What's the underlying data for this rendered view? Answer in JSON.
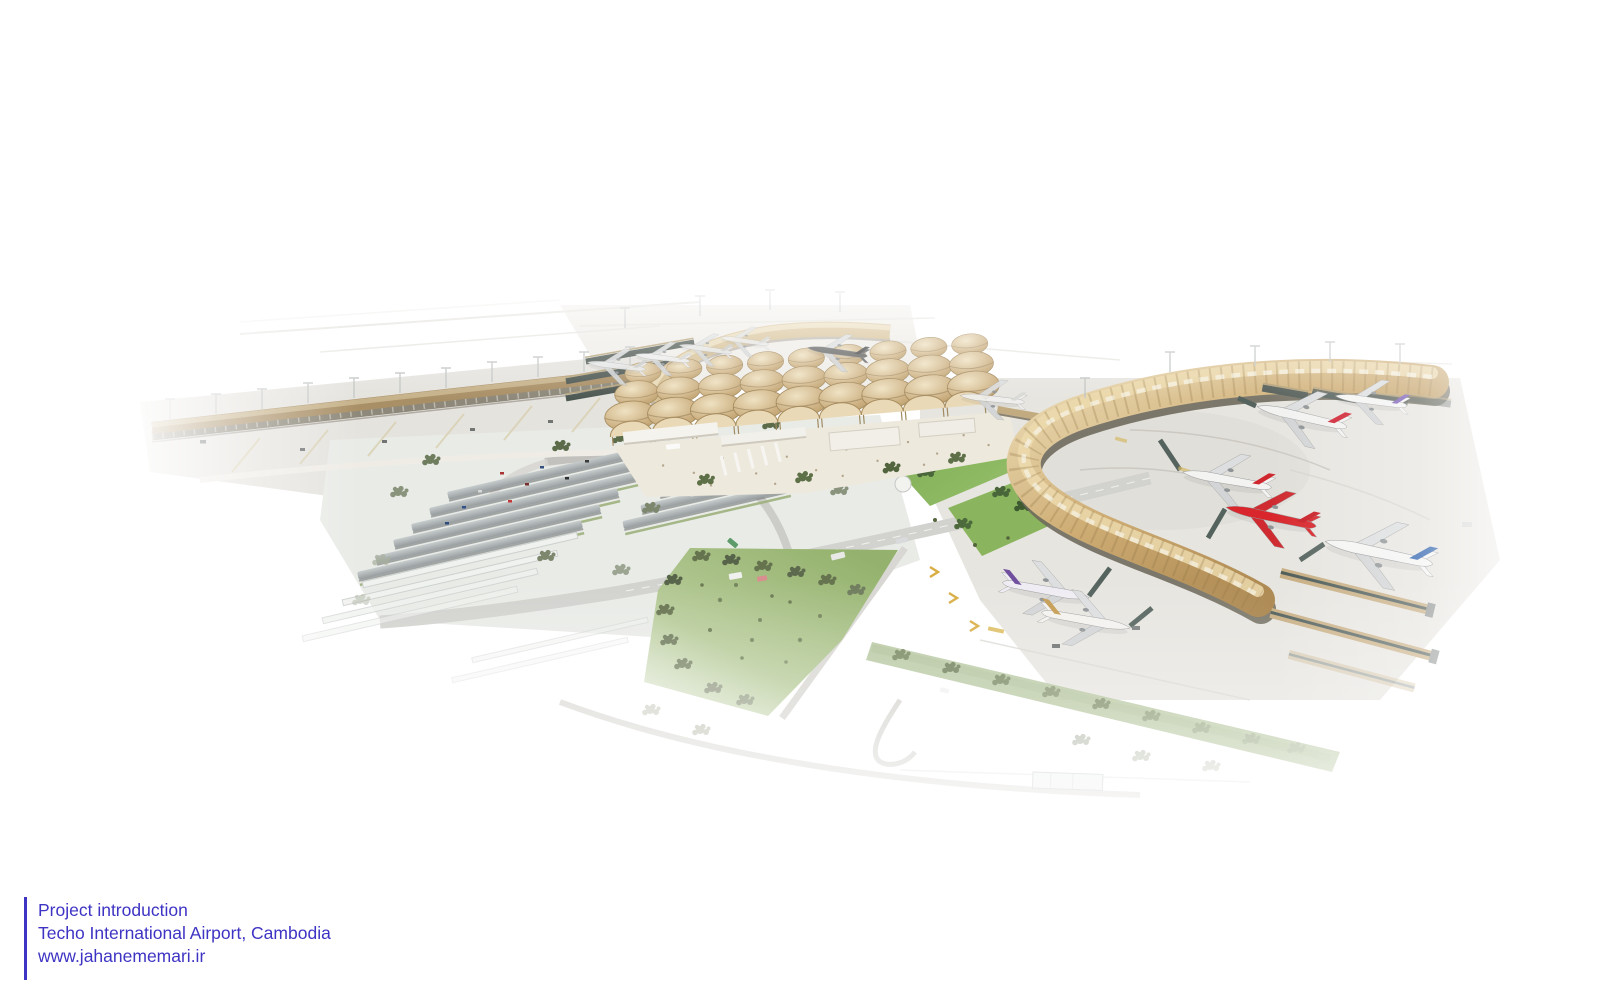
{
  "caption": {
    "line1": "Project introduction",
    "line2": "Techo International Airport, Cambodia",
    "line3": "www.jahanememari.ir"
  },
  "palette": {
    "brand": "#3e34c4",
    "terminal-roof-tan": "#cdb183",
    "terminal-roof-light": "#e8d8b4",
    "concourse-gold": "#cfae76",
    "concourse-gold-dark": "#a8834b",
    "facade-dark": "#6f6a5d",
    "apron-concrete": "#e6e4df",
    "lawn-green": "#7cab51",
    "park-green": "#9cb877",
    "tree-dark": "#4d6138",
    "tree-gray": "#7f8c6a",
    "carport-gray": "#b9bfc1",
    "road-gray": "#d2d2cf",
    "jetbridge-teal": "#4d5b57",
    "stand-marking-yellow": "#d9ae45",
    "background": "#ffffff"
  },
  "aircraft": [
    {
      "id": "remote-stand-a",
      "fuselage": "#e6e7e7",
      "tail": "#c9cccc",
      "x": 617,
      "y": 366,
      "rot": 187,
      "len": 60,
      "flip": true,
      "opacity": 0.9
    },
    {
      "id": "remote-stand-b",
      "fuselage": "#eceded",
      "tail": "#d3d5d5",
      "x": 663,
      "y": 358,
      "rot": 187,
      "len": 56,
      "flip": true,
      "opacity": 0.92
    },
    {
      "id": "remote-stand-c",
      "fuselage": "#e4e5e5",
      "tail": "#c6c8c8",
      "x": 706,
      "y": 349,
      "rot": 188,
      "len": 54,
      "flip": true,
      "opacity": 0.9
    },
    {
      "id": "remote-stand-d",
      "fuselage": "#eaeaea",
      "tail": "#d0d2d2",
      "x": 745,
      "y": 341,
      "rot": 188,
      "len": 50,
      "flip": true,
      "opacity": 0.85
    },
    {
      "id": "taxiing-dark-livery",
      "fuselage": "#5f6161",
      "tail": "#424445",
      "x": 838,
      "y": 352,
      "rot": 188,
      "len": 62,
      "flip": true,
      "opacity": 0.95
    },
    {
      "id": "gate-white",
      "fuselage": "#f0f0ee",
      "tail": "#d8d8d6",
      "x": 993,
      "y": 399,
      "rot": 186,
      "len": 66,
      "flip": true,
      "opacity": 0.9
    },
    {
      "id": "purple-tail-regional",
      "fuselage": "#f4f4f3",
      "tail": "#7f63b8",
      "x": 1372,
      "y": 401,
      "rot": 188,
      "len": 74,
      "flip": true,
      "opacity": 1
    },
    {
      "id": "red-tail-widebody",
      "fuselage": "#f2f2f1",
      "tail": "#cf2130",
      "x": 1303,
      "y": 417,
      "rot": 193,
      "len": 94,
      "flip": true,
      "opacity": 1
    },
    {
      "id": "red-tail-narrowbody",
      "fuselage": "#f3f3f2",
      "tail": "#d0272f",
      "x": 1228,
      "y": 480,
      "rot": 190,
      "len": 92,
      "flip": true,
      "opacity": 1
    },
    {
      "id": "lowcost-all-red",
      "fuselage": "#d8262c",
      "tail": "#c81e26",
      "wing": "#cf2b30",
      "x": 1272,
      "y": 517,
      "rot": 192,
      "len": 94,
      "flip": true,
      "opacity": 1
    },
    {
      "id": "blue-tail-widebody",
      "fuselage": "#f4f4f3",
      "tail": "#2e62ae",
      "x": 1380,
      "y": 553,
      "rot": 192,
      "len": 112,
      "flip": true,
      "opacity": 1
    },
    {
      "id": "purple-livery-narrowbody",
      "fuselage": "#efecf3",
      "tail": "#6f4f9e",
      "x": 1045,
      "y": 590,
      "rot": 10,
      "flip": false,
      "len": 90,
      "opacity": 1
    },
    {
      "id": "gold-tail-narrowbody",
      "fuselage": "#f3f2ef",
      "tail": "#c59c52",
      "x": 1085,
      "y": 620,
      "rot": 10,
      "flip": false,
      "len": 92,
      "opacity": 1
    }
  ]
}
